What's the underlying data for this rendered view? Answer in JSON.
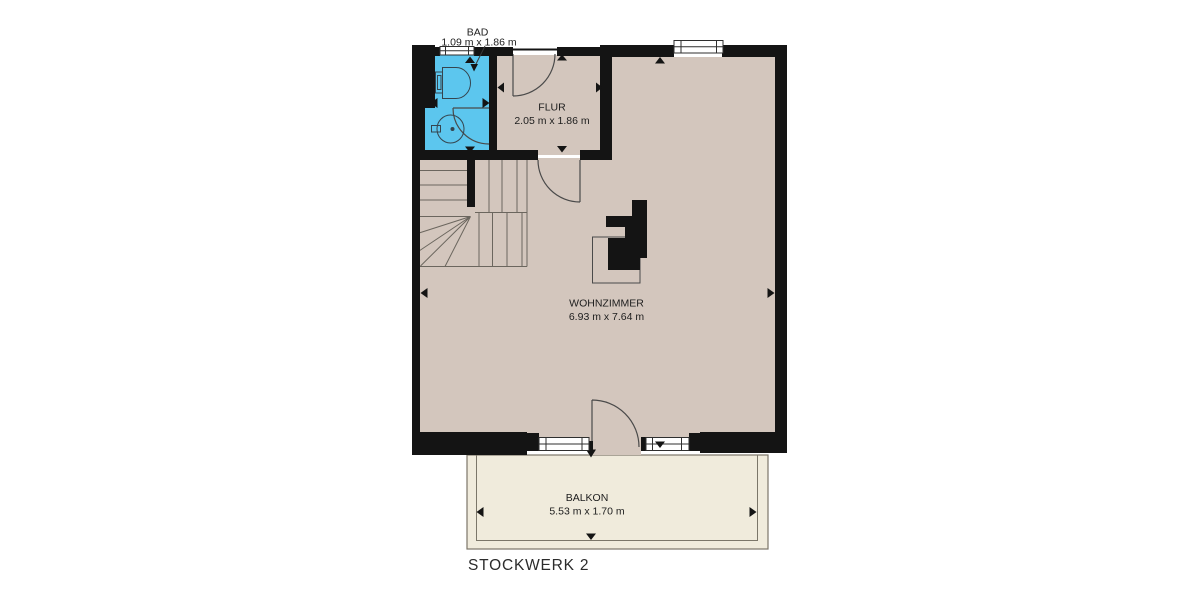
{
  "floorplan": {
    "floor_label": "STOCKWERK 2",
    "rooms": [
      {
        "id": "bad",
        "name": "BAD",
        "dimensions": "1.09 m x 1.86 m"
      },
      {
        "id": "flur",
        "name": "FLUR",
        "dimensions": "2.05 m x 1.86 m"
      },
      {
        "id": "wohnzimmer",
        "name": "WOHNZIMMER",
        "dimensions": "6.93 m x 7.64 m"
      },
      {
        "id": "balkon",
        "name": "BALKON",
        "dimensions": "5.53 m x 1.70 m"
      }
    ],
    "fixtures": [
      {
        "name": "toilet"
      },
      {
        "name": "washbasin"
      }
    ],
    "colors": {
      "background": "#ffffff",
      "floor": "#d3c6bd",
      "bathroom_floor": "#5cc6ee",
      "balcony_floor": "#f0ebdc",
      "wall": "#141414",
      "stair_line": "#6b665e",
      "door_line": "#4a4a4a"
    }
  }
}
